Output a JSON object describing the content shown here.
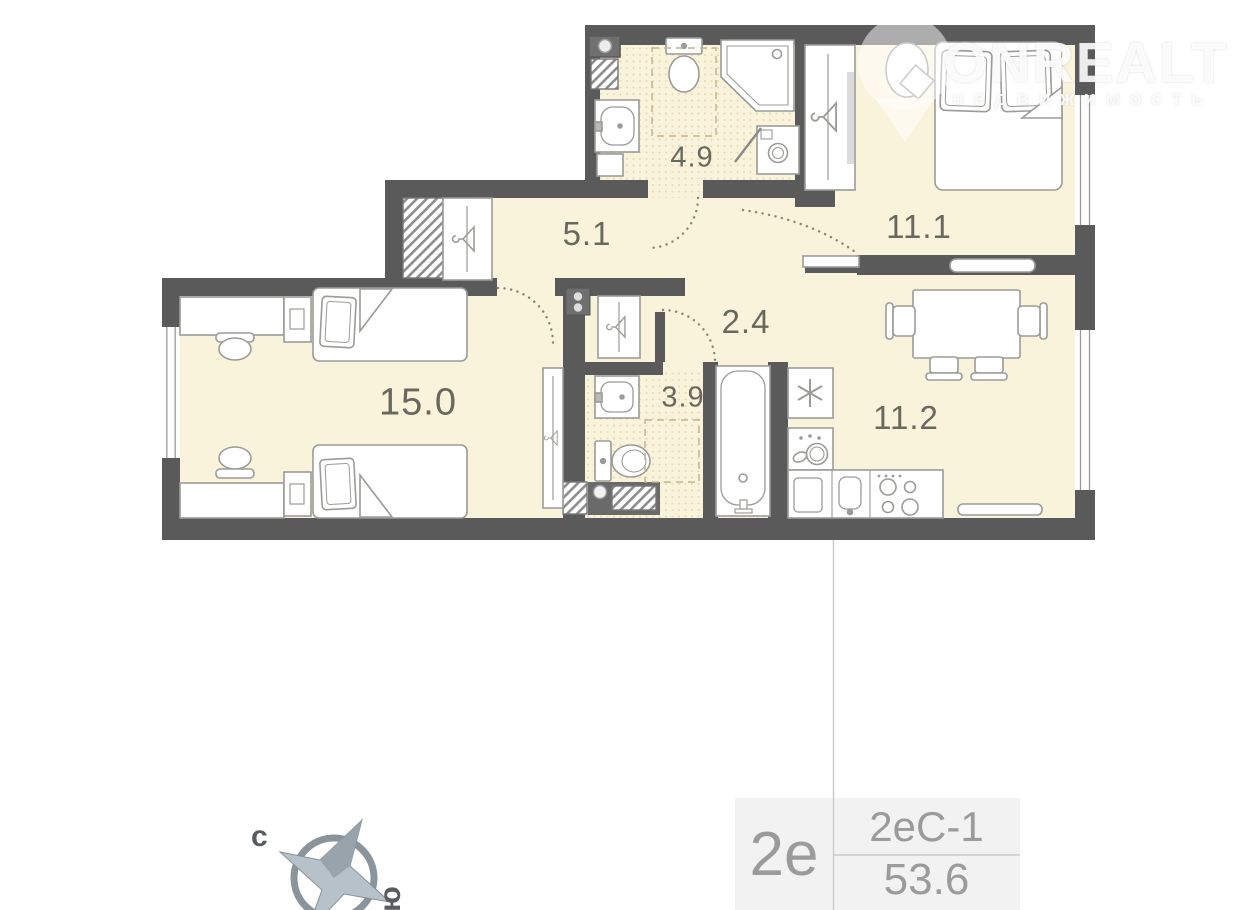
{
  "watermark": {
    "brand": "ONREALT",
    "subtitle": "недвижимость"
  },
  "rooms": [
    {
      "name": "bathroom-top",
      "area_label": "4.9"
    },
    {
      "name": "hallway",
      "area_label": "5.1"
    },
    {
      "name": "bedroom",
      "area_label": "11.1"
    },
    {
      "name": "corridor",
      "area_label": "2.4"
    },
    {
      "name": "living-room",
      "area_label": "15.0"
    },
    {
      "name": "bathroom-bottom",
      "area_label": "3.9"
    },
    {
      "name": "kitchen",
      "area_label": "11.2"
    }
  ],
  "compass": {
    "north": "с",
    "south": "ю"
  },
  "info": {
    "layout_short": "2е",
    "layout_code": "2еС-1",
    "total_area": "53.6"
  },
  "colors": {
    "wall": "#5a5a5a",
    "floor": "#faf3dc",
    "floor_dot": "#e9d8b2",
    "furniture_stroke": "#9b9b97",
    "label_text": "#68685f",
    "info_text": "#9b9b9b",
    "compass": "#8b939b",
    "connector_line": "#c6cacd",
    "watermark_text": "#ececec"
  }
}
